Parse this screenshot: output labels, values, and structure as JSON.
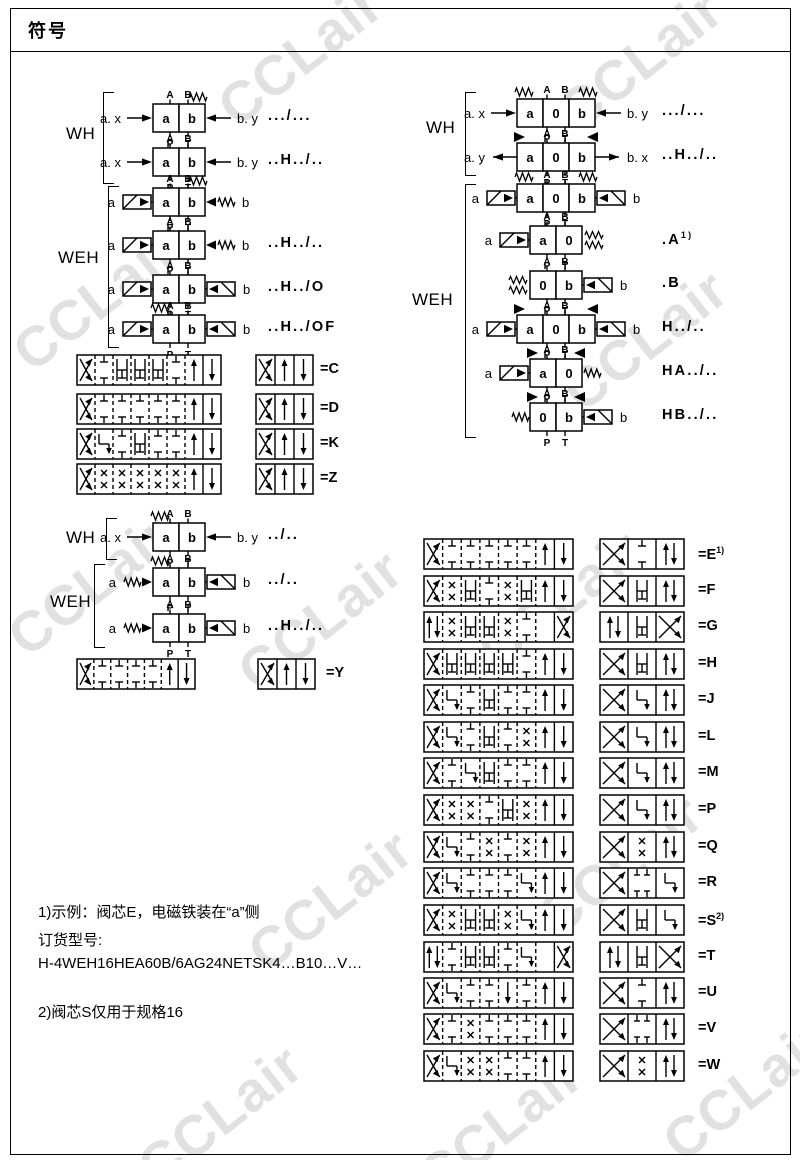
{
  "page": {
    "title": "符号"
  },
  "watermark": {
    "text": "CCLair",
    "color": "#c4c4c4"
  },
  "ports": {
    "a": "A",
    "b": "B",
    "p": "P",
    "t": "T"
  },
  "groups": {
    "left_wh1": "WH",
    "left_weh1": "WEH",
    "left_wh2": "WH",
    "left_weh2": "WEH",
    "right_wh": "WH",
    "right_weh": "WEH"
  },
  "valves": {
    "left": [
      {
        "cy": 118,
        "cx": 179,
        "boxes": [
          "a",
          "b"
        ],
        "top": [
          "sprTR"
        ],
        "left": [
          "lab:a. x",
          "arrowIn"
        ],
        "right": [
          "arrowIn",
          "lab:b. y"
        ],
        "code": ".../...",
        "code_x": 268
      },
      {
        "cy": 162,
        "cx": 179,
        "boxes": [
          "a",
          "b"
        ],
        "top": [],
        "left": [
          "lab:a. x",
          "arrowIn"
        ],
        "right": [
          "arrowIn",
          "lab:b. y"
        ],
        "code": "..H../..",
        "code_x": 268
      },
      {
        "cy": 202,
        "cx": 179,
        "boxes": [
          "a",
          "b"
        ],
        "top": [
          "sprTR"
        ],
        "left": [
          "lab:a",
          "sol"
        ],
        "right": [
          "triIn",
          "spr",
          "lab:b"
        ],
        "code": "",
        "code_x": 268
      },
      {
        "cy": 245,
        "cx": 179,
        "boxes": [
          "a",
          "b"
        ],
        "top": [],
        "left": [
          "lab:a",
          "sol"
        ],
        "right": [
          "triIn",
          "spr",
          "lab:b"
        ],
        "code": "..H../..",
        "code_x": 268
      },
      {
        "cy": 289,
        "cx": 179,
        "boxes": [
          "a",
          "b"
        ],
        "top": [],
        "left": [
          "lab:a",
          "sol"
        ],
        "right": [
          "sol",
          "lab:b"
        ],
        "code": "..H../O",
        "code_x": 268
      },
      {
        "cy": 329,
        "cx": 179,
        "boxes": [
          "a",
          "b"
        ],
        "top": [
          "sprTL"
        ],
        "left": [
          "lab:a",
          "sol"
        ],
        "right": [
          "sol",
          "lab:b"
        ],
        "code": "..H../OF",
        "code_x": 268
      },
      {
        "cy": 537,
        "cx": 179,
        "boxes": [
          "a",
          "b"
        ],
        "top": [
          "sprTL"
        ],
        "left": [
          "lab:a. x",
          "arrowIn"
        ],
        "right": [
          "arrowIn",
          "lab:b. y"
        ],
        "code": "../..",
        "code_x": 268
      },
      {
        "cy": 582,
        "cx": 179,
        "boxes": [
          "a",
          "b"
        ],
        "top": [
          "sprTL"
        ],
        "left": [
          "lab:a",
          "spr",
          "triIn"
        ],
        "right": [
          "sol",
          "lab:b"
        ],
        "code": "../..",
        "code_x": 268
      },
      {
        "cy": 628,
        "cx": 179,
        "boxes": [
          "a",
          "b"
        ],
        "top": [],
        "left": [
          "lab:a",
          "spr",
          "triIn"
        ],
        "right": [
          "sol",
          "lab:b"
        ],
        "code": "..H../..",
        "code_x": 268
      }
    ],
    "right": [
      {
        "cy": 113,
        "cx": 556,
        "boxes": [
          "a",
          "0",
          "b"
        ],
        "top": [
          "sprTL",
          "sprTR"
        ],
        "left": [
          "lab:a. x",
          "arrowIn"
        ],
        "right": [
          "arrowIn",
          "lab:b. y"
        ],
        "code": ".../...",
        "code_x": 662
      },
      {
        "cy": 157,
        "cx": 556,
        "boxes": [
          "a",
          "0",
          "b"
        ],
        "top": [
          "triTL",
          "triTR"
        ],
        "left": [
          "lab:a. y",
          "arrowOut"
        ],
        "right": [
          "arrowOut",
          "lab:b. x"
        ],
        "code": "..H../..",
        "code_x": 662
      },
      {
        "cy": 198,
        "cx": 556,
        "boxes": [
          "a",
          "0",
          "b"
        ],
        "top": [
          "sprTL",
          "sprTR"
        ],
        "left": [
          "lab:a",
          "sol"
        ],
        "right": [
          "sol",
          "lab:b"
        ],
        "code": "",
        "code_x": 662
      },
      {
        "cy": 240,
        "cx": 556,
        "boxes": [
          "a",
          "0"
        ],
        "top": [],
        "left": [
          "lab:a",
          "sol"
        ],
        "right": [
          "spr2"
        ],
        "code": ".A",
        "sup": "1)",
        "code_x": 662
      },
      {
        "cy": 285,
        "cx": 556,
        "boxes": [
          "0",
          "b"
        ],
        "top": [],
        "left": [
          "spr2"
        ],
        "right": [
          "sol",
          "lab:b"
        ],
        "code": ".B",
        "code_x": 662
      },
      {
        "cy": 329,
        "cx": 556,
        "boxes": [
          "a",
          "0",
          "b"
        ],
        "top": [
          "triTL",
          "triTR"
        ],
        "left": [
          "lab:a",
          "sol"
        ],
        "right": [
          "sol",
          "lab:b"
        ],
        "code": "H../..",
        "code_x": 662
      },
      {
        "cy": 373,
        "cx": 556,
        "boxes": [
          "a",
          "0"
        ],
        "top": [
          "triTL",
          "triTR"
        ],
        "left": [
          "lab:a",
          "sol"
        ],
        "right": [
          "spr"
        ],
        "code": "HA../..",
        "code_x": 662
      },
      {
        "cy": 417,
        "cx": 556,
        "boxes": [
          "0",
          "b"
        ],
        "top": [
          "triTL",
          "triTR"
        ],
        "left": [
          "spr"
        ],
        "right": [
          "sol",
          "lab:b"
        ],
        "code": "HB../..",
        "code_x": 662
      }
    ]
  },
  "spools": {
    "left": [
      {
        "code": "=C",
        "y": 354,
        "wx": 76,
        "ww": 144,
        "sx": 255,
        "sw": 57,
        "code_x": 320,
        "wide": [
          "x",
          "t",
          "h",
          "h",
          "h",
          "t",
          "u",
          "d"
        ],
        "compact": [
          "x",
          "u",
          "d"
        ]
      },
      {
        "code": "=D",
        "y": 393,
        "wx": 76,
        "ww": 144,
        "sx": 255,
        "sw": 57,
        "code_x": 320,
        "wide": [
          "x",
          "t",
          "t",
          "t",
          "t",
          "t",
          "u",
          "d"
        ],
        "compact": [
          "x",
          "u",
          "d"
        ]
      },
      {
        "code": "=K",
        "y": 428,
        "wx": 76,
        "ww": 144,
        "sx": 255,
        "sw": 57,
        "code_x": 320,
        "wide": [
          "x",
          "j",
          "t",
          "h",
          "t",
          "t",
          "u",
          "d"
        ],
        "compact": [
          "x",
          "u",
          "d"
        ]
      },
      {
        "code": "=Z",
        "y": 463,
        "wx": 76,
        "ww": 144,
        "sx": 255,
        "sw": 57,
        "code_x": 320,
        "wide": [
          "x",
          "xx",
          "xx",
          "xx",
          "xx",
          "xx",
          "u",
          "d"
        ],
        "compact": [
          "x",
          "u",
          "d"
        ]
      }
    ],
    "y_row": {
      "code": "=Y",
      "y": 658,
      "wx": 76,
      "ww": 118,
      "sx": 257,
      "sw": 57,
      "code_x": 326,
      "wide": [
        "x",
        "t",
        "t",
        "t",
        "t",
        "u",
        "d"
      ],
      "compact": [
        "x",
        "u",
        "d"
      ]
    },
    "right": [
      {
        "code": "=E",
        "sup": "1)",
        "y": 538,
        "wx": 423,
        "ww": 149,
        "sx": 599,
        "sw": 84,
        "code_x": 698,
        "wide": [
          "x",
          "t",
          "t",
          "t",
          "t",
          "t",
          "u",
          "d"
        ],
        "compact": [
          "x",
          "t",
          "v"
        ]
      },
      {
        "code": "=F",
        "y": 575,
        "wx": 423,
        "ww": 149,
        "sx": 599,
        "sw": 84,
        "code_x": 698,
        "wide": [
          "x",
          "xx",
          "h",
          "t",
          "xx",
          "h",
          "u",
          "d"
        ],
        "compact": [
          "x",
          "h",
          "v"
        ]
      },
      {
        "code": "=G",
        "y": 611,
        "wx": 423,
        "ww": 149,
        "sx": 599,
        "sw": 84,
        "code_x": 698,
        "wide": [
          "v",
          "xx",
          "h",
          "h",
          "xx",
          "t",
          "b",
          "x"
        ],
        "compact": [
          "v",
          "h",
          "x"
        ]
      },
      {
        "code": "=H",
        "y": 648,
        "wx": 423,
        "ww": 149,
        "sx": 599,
        "sw": 84,
        "code_x": 698,
        "wide": [
          "x",
          "h",
          "h",
          "h",
          "h",
          "t",
          "u",
          "d"
        ],
        "compact": [
          "x",
          "h",
          "v"
        ]
      },
      {
        "code": "=J",
        "y": 684,
        "wx": 423,
        "ww": 149,
        "sx": 599,
        "sw": 84,
        "code_x": 698,
        "wide": [
          "x",
          "j",
          "t",
          "h",
          "t",
          "t",
          "u",
          "d"
        ],
        "compact": [
          "x",
          "j",
          "v"
        ]
      },
      {
        "code": "=L",
        "y": 721,
        "wx": 423,
        "ww": 149,
        "sx": 599,
        "sw": 84,
        "code_x": 698,
        "wide": [
          "x",
          "j",
          "t",
          "h",
          "t",
          "xx",
          "u",
          "d"
        ],
        "compact": [
          "x",
          "j",
          "v"
        ]
      },
      {
        "code": "=M",
        "y": 757,
        "wx": 423,
        "ww": 149,
        "sx": 599,
        "sw": 84,
        "code_x": 698,
        "wide": [
          "x",
          "t",
          "j",
          "h",
          "t",
          "t",
          "u",
          "d"
        ],
        "compact": [
          "x",
          "j",
          "v"
        ]
      },
      {
        "code": "=P",
        "y": 794,
        "wx": 423,
        "ww": 149,
        "sx": 599,
        "sw": 84,
        "code_x": 698,
        "wide": [
          "x",
          "xx",
          "xx",
          "t",
          "h",
          "xx",
          "u",
          "d"
        ],
        "compact": [
          "x",
          "j",
          "v"
        ]
      },
      {
        "code": "=Q",
        "y": 831,
        "wx": 423,
        "ww": 149,
        "sx": 599,
        "sw": 84,
        "code_x": 698,
        "wide": [
          "x",
          "j",
          "t",
          "xx",
          "t",
          "xx",
          "u",
          "d"
        ],
        "compact": [
          "x",
          "xx",
          "v"
        ]
      },
      {
        "code": "=R",
        "y": 867,
        "wx": 423,
        "ww": 149,
        "sx": 599,
        "sw": 84,
        "code_x": 698,
        "wide": [
          "x",
          "j",
          "t",
          "t",
          "t",
          "j",
          "u",
          "d"
        ],
        "compact": [
          "x",
          "tt",
          "j"
        ]
      },
      {
        "code": "=S",
        "sup": "2)",
        "y": 904,
        "wx": 423,
        "ww": 149,
        "sx": 599,
        "sw": 84,
        "code_x": 698,
        "wide": [
          "x",
          "xx",
          "h",
          "h",
          "xx",
          "j",
          "u",
          "d"
        ],
        "compact": [
          "x",
          "h",
          "j"
        ]
      },
      {
        "code": "=T",
        "y": 941,
        "wx": 423,
        "ww": 149,
        "sx": 599,
        "sw": 84,
        "code_x": 698,
        "wide": [
          "v",
          "t",
          "h",
          "h",
          "t",
          "j",
          "b",
          "x"
        ],
        "compact": [
          "v",
          "h",
          "x"
        ]
      },
      {
        "code": "=U",
        "y": 977,
        "wx": 423,
        "ww": 149,
        "sx": 599,
        "sw": 84,
        "code_x": 698,
        "wide": [
          "x",
          "j",
          "t",
          "t",
          "d",
          "t",
          "u",
          "d"
        ],
        "compact": [
          "x",
          "t",
          "v"
        ]
      },
      {
        "code": "=V",
        "y": 1013,
        "wx": 423,
        "ww": 149,
        "sx": 599,
        "sw": 84,
        "code_x": 698,
        "wide": [
          "x",
          "t",
          "xx",
          "t",
          "t",
          "t",
          "u",
          "d"
        ],
        "compact": [
          "x",
          "tt",
          "v"
        ]
      },
      {
        "code": "=W",
        "y": 1050,
        "wx": 423,
        "ww": 149,
        "sx": 599,
        "sw": 84,
        "code_x": 698,
        "wide": [
          "x",
          "j",
          "xx",
          "xx",
          "t",
          "t",
          "u",
          "d"
        ],
        "compact": [
          "x",
          "xx",
          "v"
        ]
      }
    ]
  },
  "footnotes": {
    "l1": "1)示例：阀芯E，电磁铁装在“a”侧",
    "l2": "订货型号:",
    "l3": "H-4WEH16HEA60B/6AG24NETSK4…B10…V…",
    "l4": "2)阀芯S仅用于规格16"
  }
}
